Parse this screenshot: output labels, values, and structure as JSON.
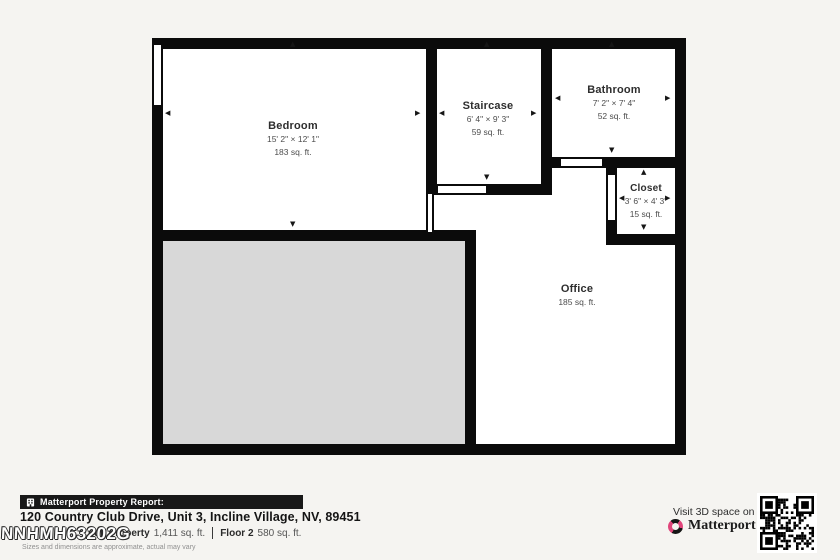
{
  "plan": {
    "rooms": {
      "bedroom": {
        "name": "Bedroom",
        "dims": "15' 2\" × 12' 1\"",
        "area": "183 sq. ft."
      },
      "staircase": {
        "name": "Staircase",
        "dims": "6' 4\" × 9' 3\"",
        "area": "59 sq. ft."
      },
      "bathroom": {
        "name": "Bathroom",
        "dims": "7' 2\" × 7' 4\"",
        "area": "52 sq. ft."
      },
      "closet": {
        "name": "Closet",
        "dims": "3' 6\" × 4' 3\"",
        "area": "15 sq. ft."
      },
      "office": {
        "name": "Office",
        "area": "185 sq. ft."
      }
    }
  },
  "icons": {
    "arrow_up": "▲",
    "arrow_down": "▼",
    "arrow_left": "◀",
    "arrow_right": "▶"
  },
  "footer": {
    "report_label": "Matterport Property Report:",
    "address": "120 Country Club Drive, Unit 3, Incline Village, NV, 89451",
    "full_property_label": "Full Property",
    "full_property_value": "1,411 sq. ft.",
    "floor_label": "Floor 2",
    "floor_value": "580 sq. ft.",
    "disclaimer": "Sizes and dimensions are approximate, actual may vary",
    "watermark": "NNHMH63202G"
  },
  "branding": {
    "visit_text": "Visit 3D space on",
    "brand_name": "Matterport",
    "trademark": "™"
  },
  "colors": {
    "wall": "#0b0b0b",
    "void_fill": "#d8d8d8",
    "bar_bg": "#181818",
    "brand_pink": "#e0457b",
    "page_bg": "#f5f4f1"
  }
}
